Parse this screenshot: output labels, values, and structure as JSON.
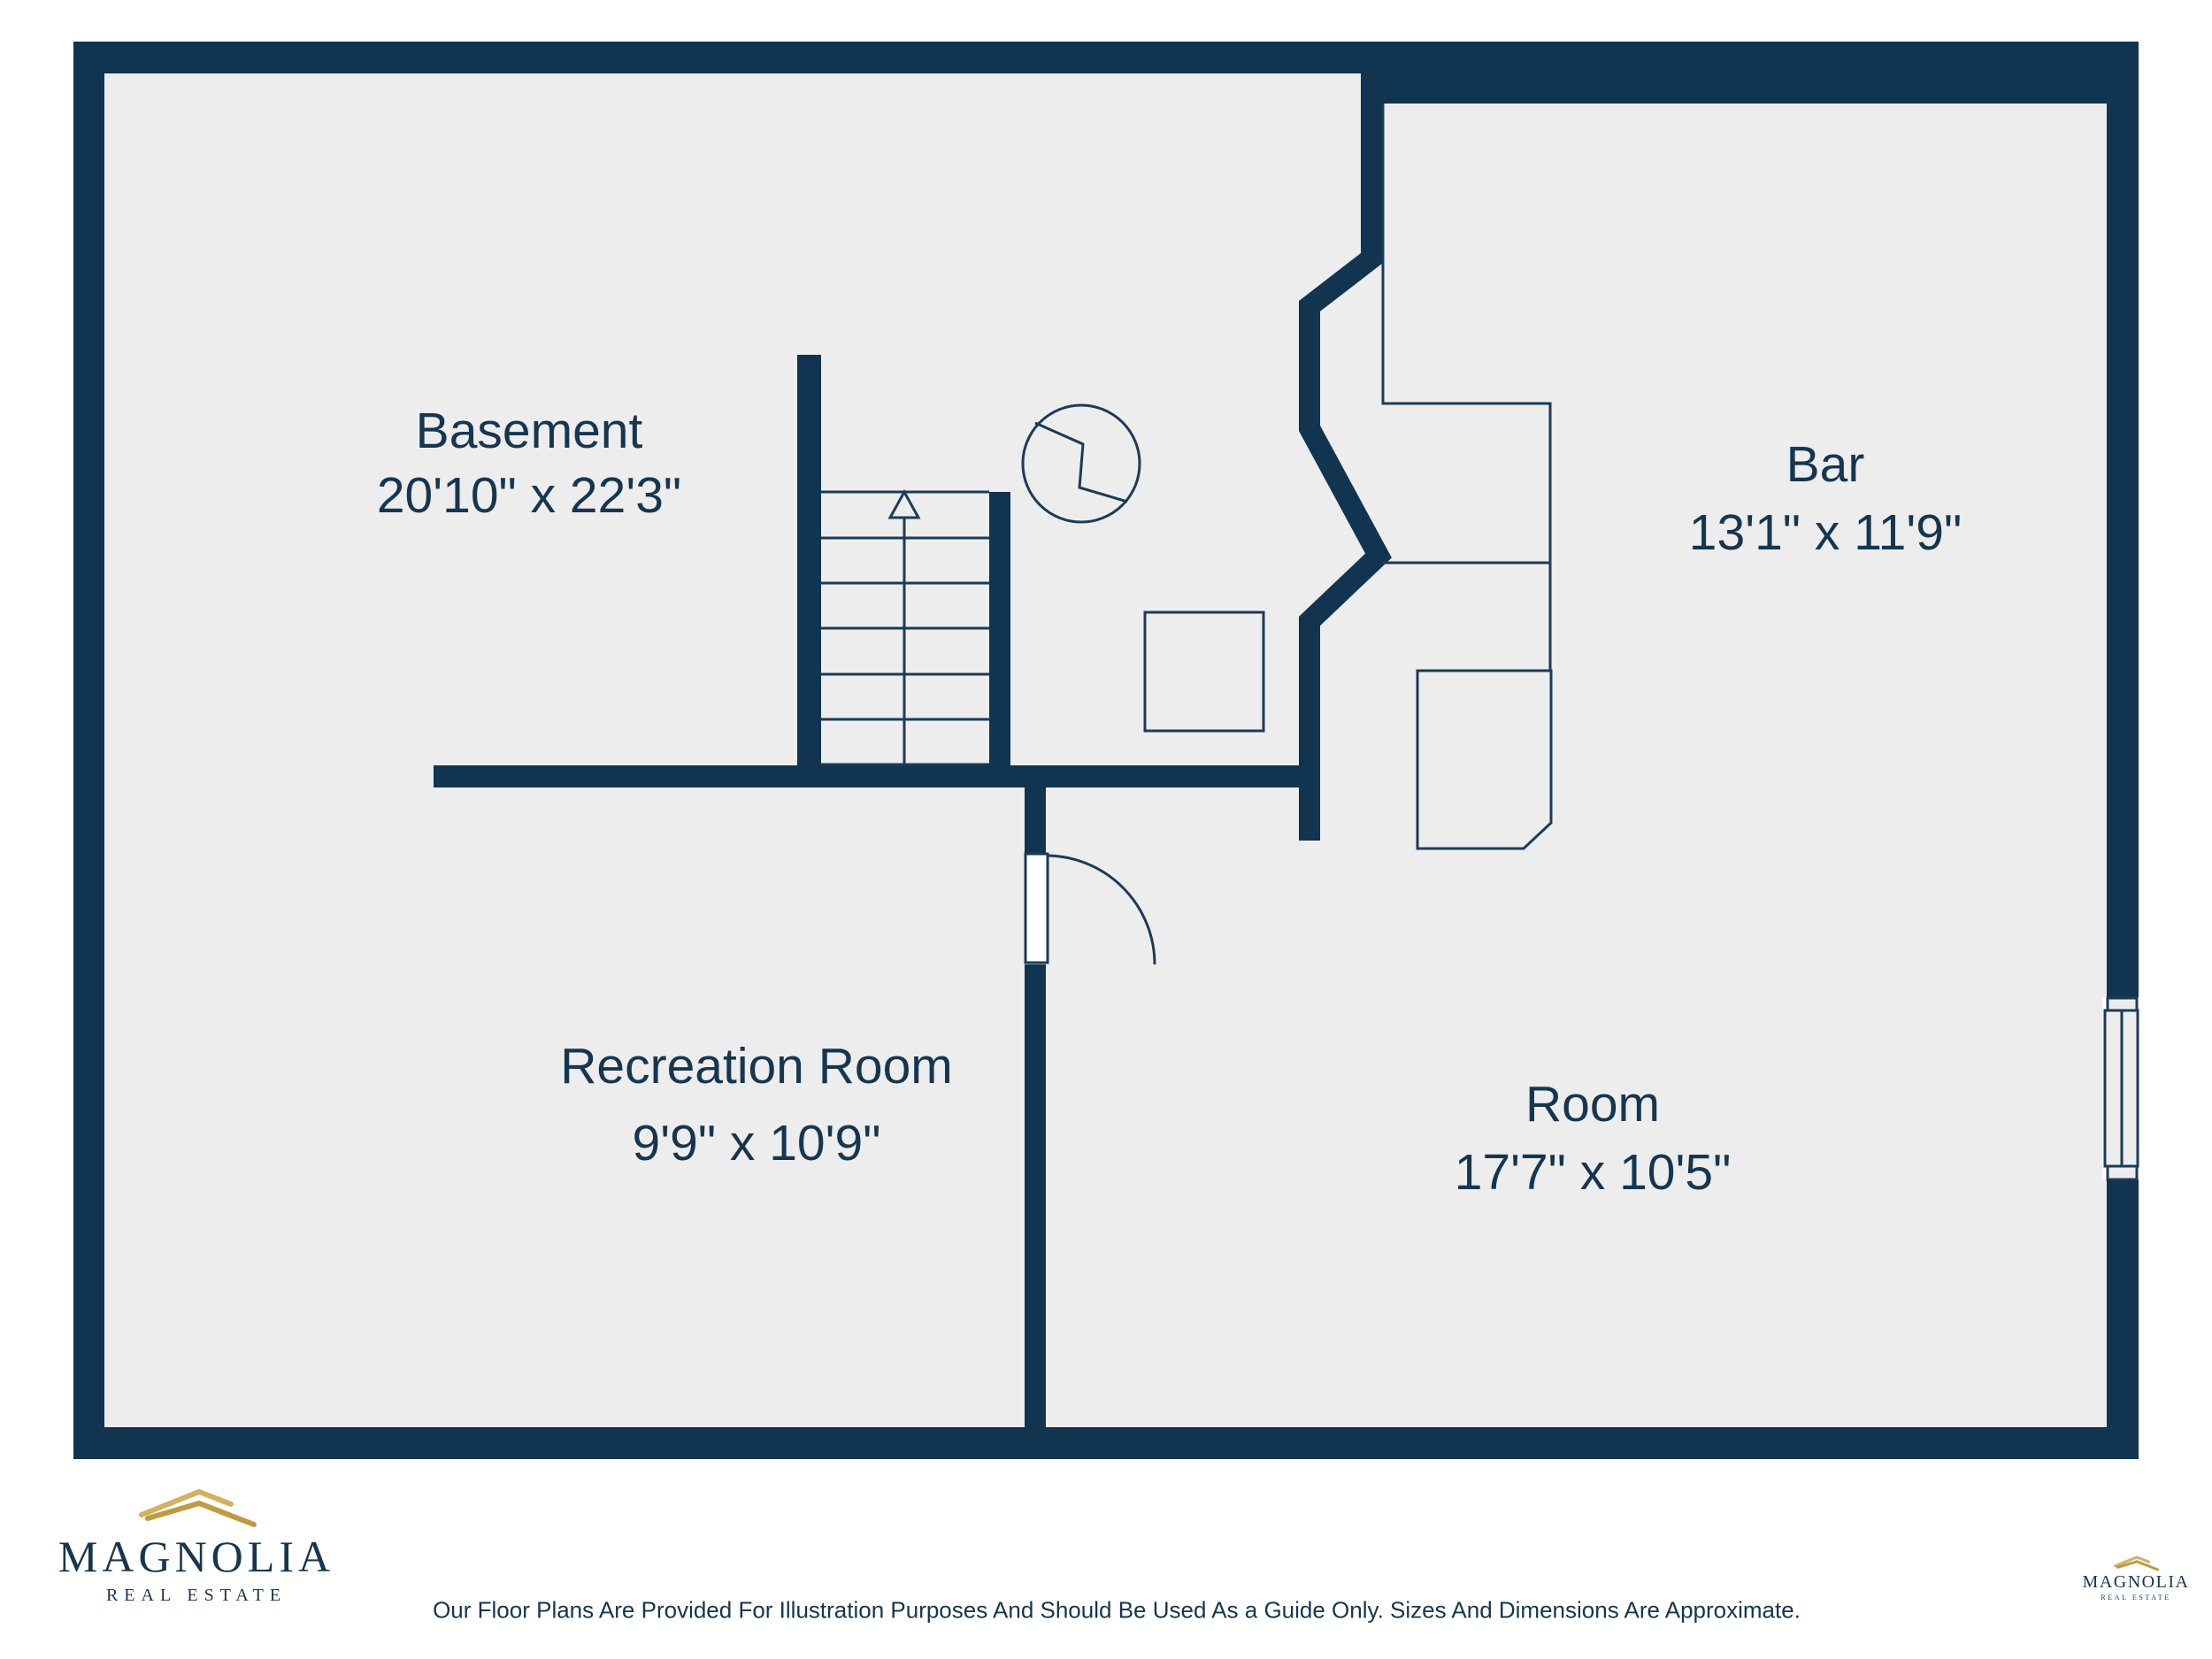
{
  "floorplan": {
    "rooms": [
      {
        "name": "Basement",
        "dims": "20'10\" x 22'3\""
      },
      {
        "name": "Bar",
        "dims": "13'1\" x 11'9\""
      },
      {
        "name": "Recreation Room",
        "dims": "9'9\" x 10'9\""
      },
      {
        "name": "Room",
        "dims": "17'7\" x 10'5\""
      }
    ],
    "symbols": [
      "stairs-up-arrow",
      "electrical-symbol",
      "support-post",
      "bar-counter",
      "door-swing",
      "window"
    ]
  },
  "branding": {
    "name": "MAGNOLIA",
    "subtitle": "REAL ESTATE"
  },
  "footer": {
    "disclaimer": "Our Floor Plans Are Provided For Illustration Purposes And Should Be Used As a Guide Only. Sizes And Dimensions Are Approximate."
  },
  "colors": {
    "wall_navy": "#113450",
    "line_navy": "#1c3b57",
    "floor_gray": "#ededee",
    "logo_gold_light": "#d4b063",
    "logo_gold_dark": "#c09a42",
    "text_navy": "#16364f"
  }
}
